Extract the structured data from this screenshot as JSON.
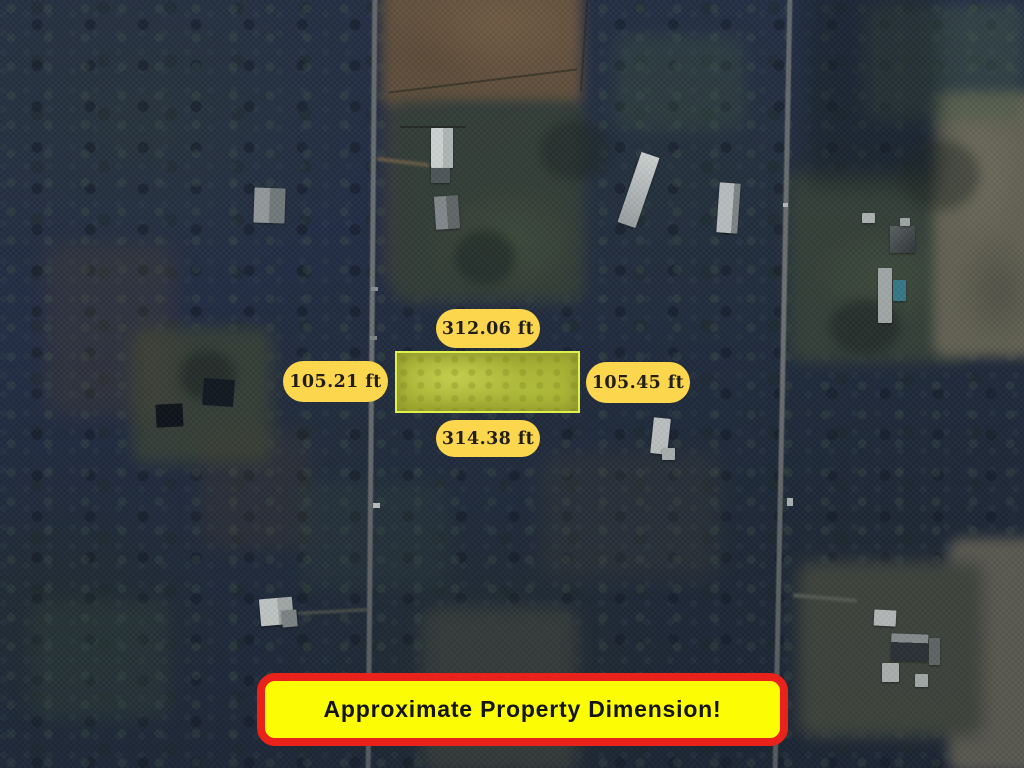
{
  "map": {
    "dimension_labels": {
      "top": "312.06 ft",
      "left": "105.21 ft",
      "right": "105.45 ft",
      "bottom": "314.38 ft"
    },
    "banner": {
      "text": "Approximate Property Dimension!"
    },
    "colors": {
      "pill_bg": "#fcd74d",
      "pill_text": "#221e1b",
      "banner_bg": "#fcfc05",
      "banner_border": "#e9231b",
      "banner_text": "#141414",
      "property_fill": "#a9b236",
      "property_border": "#e2f04c"
    }
  }
}
